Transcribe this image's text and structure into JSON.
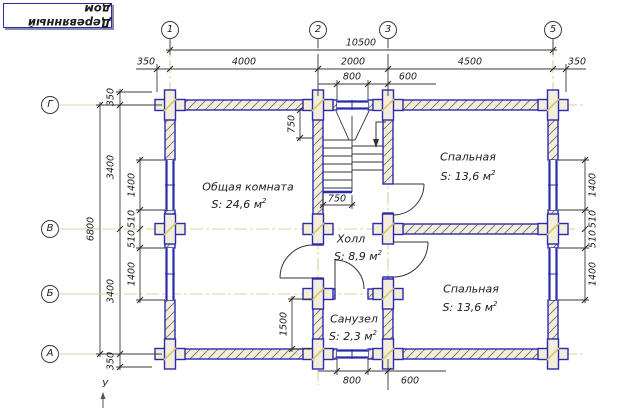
{
  "title": {
    "text": "Деревянный дом"
  },
  "axes": {
    "col_1": "1",
    "col_2": "2",
    "col_3": "3",
    "col_5": "5",
    "row_g": "Г",
    "row_v": "В",
    "row_b": "Б",
    "row_a": "А"
  },
  "dims": {
    "overall_width": "10500",
    "top_row": {
      "d0": "350",
      "d1": "4000",
      "d2": "2000",
      "d3": "4500",
      "d4": "350"
    },
    "top_sub": {
      "d0": "800",
      "d1": "600"
    },
    "bottom_sub": {
      "d0": "800",
      "d1": "600"
    },
    "overall_height": "6800",
    "left_row": {
      "d0": "350",
      "d1": "3400",
      "d2": "3400",
      "d3": "350"
    },
    "left_windows": {
      "d0": "1400",
      "d1": "510",
      "d2": "510",
      "d3": "1400"
    },
    "right_windows": {
      "d0": "1400",
      "d1": "510",
      "d2": "510",
      "d3": "1400"
    },
    "stair_top": "750",
    "stair_width": "750",
    "bath_height": "1500"
  },
  "rooms": {
    "living": {
      "name": "Общая комната",
      "area": "S: 24,6 м",
      "sup": "2"
    },
    "bedroom_top": {
      "name": "Спальная",
      "area": "S: 13,6 м",
      "sup": "2"
    },
    "hall": {
      "name": "Холл",
      "area": "S: 8,9 м",
      "sup": "2"
    },
    "bathroom": {
      "name": "Санузел",
      "area": "S: 2,3 м",
      "sup": "2"
    },
    "bedroom_bottom": {
      "name": "Спальная",
      "area": "S: 13,6 м",
      "sup": "2"
    }
  },
  "coord_axis_label": "У",
  "colors": {
    "wall_edge": "#2a2ab0",
    "wall_fill": "#f3eedc",
    "axis_line": "#ddd29a",
    "dim_line": "#3a3a3a",
    "log_tick": "#d8c868"
  }
}
